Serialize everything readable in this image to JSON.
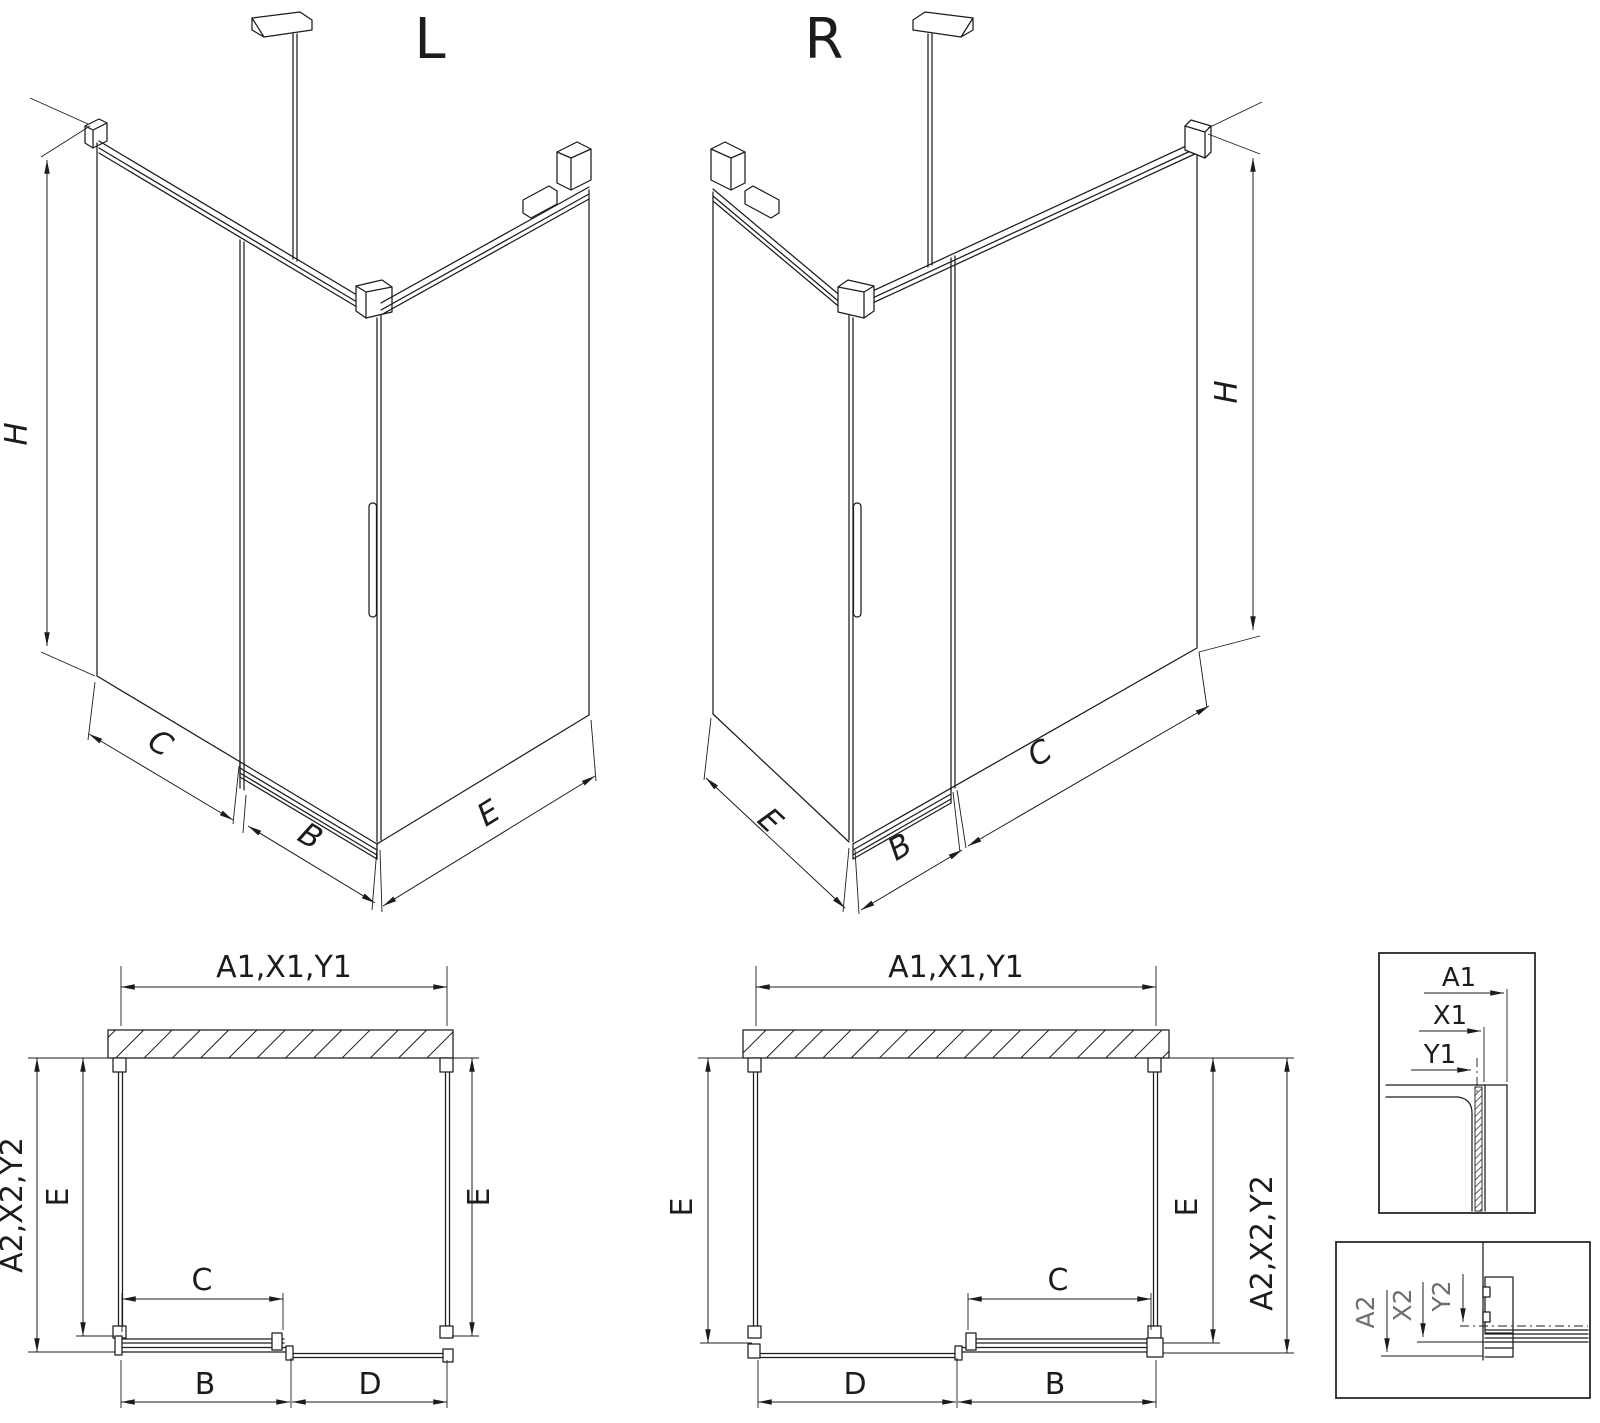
{
  "page": {
    "background": "#ffffff",
    "line_color": "#1c1c1c",
    "detail_label_color": "#6e6e6e"
  },
  "iso_left": {
    "title": "L",
    "dim_h": "H",
    "dim_c": "C",
    "dim_b": "B",
    "dim_e": "E"
  },
  "iso_right": {
    "title": "R",
    "dim_h": "H",
    "dim_e": "E",
    "dim_b": "B",
    "dim_c": "C"
  },
  "plan_left": {
    "dim_width": "A1,X1,Y1",
    "dim_side": "A2,X2,Y2",
    "dim_e_left": "E",
    "dim_e_right": "E",
    "dim_c": "C",
    "dim_b": "B",
    "dim_d": "D"
  },
  "plan_right": {
    "dim_width": "A1,X1,Y1",
    "dim_side": "A2,X2,Y2",
    "dim_e_left": "E",
    "dim_e_right": "E",
    "dim_c": "C",
    "dim_b": "B",
    "dim_d": "D"
  },
  "detail_top": {
    "dim_a": "A1",
    "dim_x": "X1",
    "dim_y": "Y1"
  },
  "detail_bottom": {
    "dim_a": "A2",
    "dim_x": "X2",
    "dim_y": "Y2"
  }
}
